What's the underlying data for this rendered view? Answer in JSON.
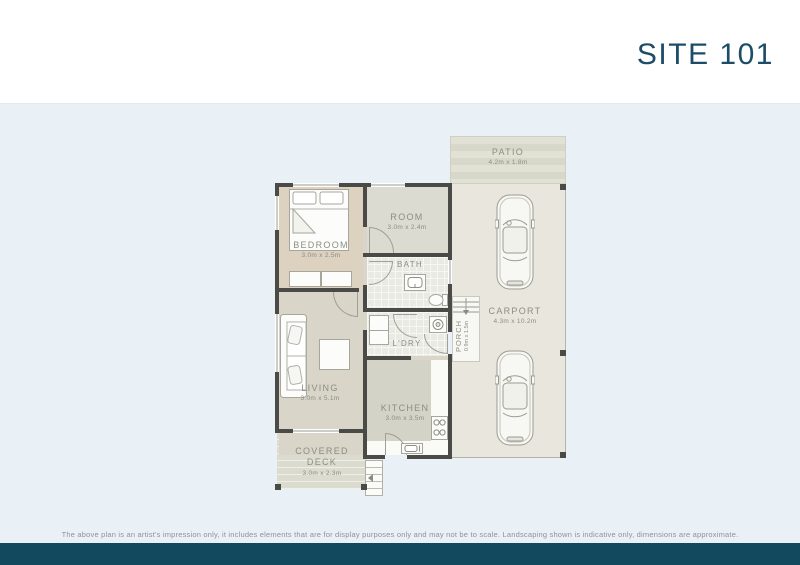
{
  "header": {
    "title": "SITE 101"
  },
  "plan": {
    "rooms": {
      "patio": {
        "label": "PATIO",
        "dims": "4.2m x 1.8m"
      },
      "carport": {
        "label": "CARPORT",
        "dims": "4.3m x 10.2m"
      },
      "bedroom": {
        "label": "BEDROOM",
        "dims": "3.0m x 2.5m"
      },
      "room": {
        "label": "ROOM",
        "dims": "3.0m x 2.4m"
      },
      "bath": {
        "label": "BATH"
      },
      "laundry": {
        "label": "L'DRY"
      },
      "porch": {
        "label": "PORCH",
        "dims": "0.9m x 1.5m"
      },
      "living": {
        "label": "LIVING",
        "dims": "3.0m x 5.1m"
      },
      "kitchen": {
        "label": "KITCHEN",
        "dims": "3.0m x 3.5m"
      },
      "deck": {
        "label": "COVERED DECK",
        "dims": "3.0m x 2.3m"
      }
    },
    "icons": [
      "bed-icon",
      "dresser-icon",
      "sofa-icon",
      "coffee-table-icon",
      "toilet-icon",
      "vanity-sink-icon",
      "washing-machine-icon",
      "linen-cupboard-icon",
      "stove-icon",
      "kitchen-sink-icon",
      "car-icon",
      "steps-icon"
    ]
  },
  "footer": {
    "disclaimer": "The above plan is an artist's impression only, it includes elements that are for display purposes only and may not be to scale. Landscaping shown is indicative only, dimensions are approximate."
  },
  "colors": {
    "accent": "#1d4c68",
    "footer_bar": "#12495f",
    "canvas": "#eaf1f6",
    "wall": "#4a4a46"
  }
}
